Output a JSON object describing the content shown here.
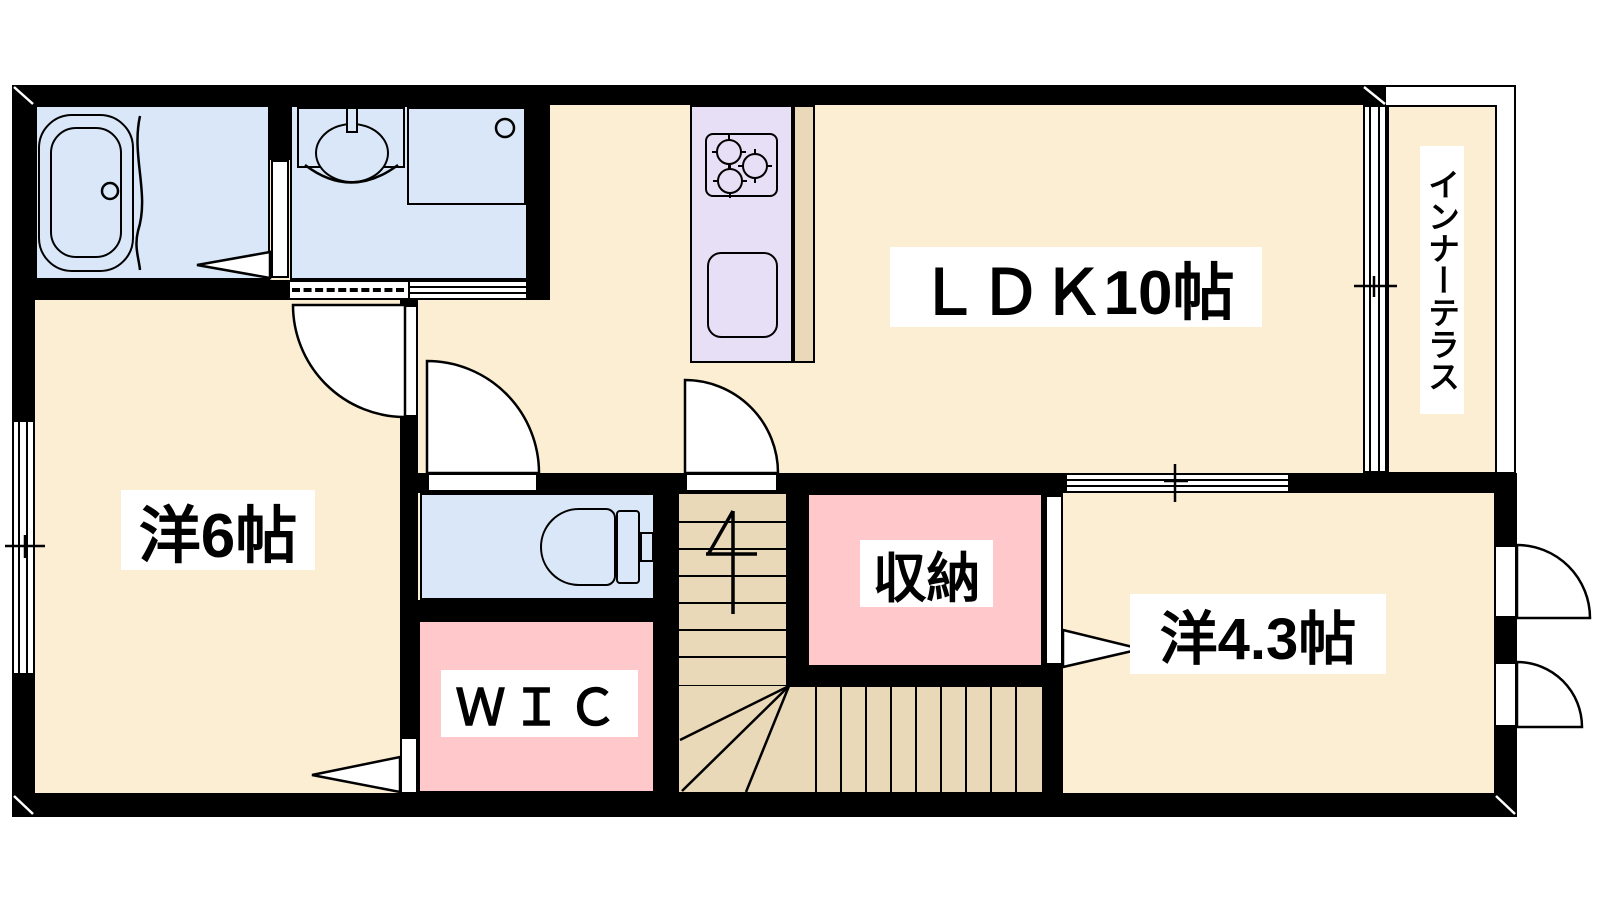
{
  "floorplan": {
    "rooms": {
      "ldk": {
        "label": "ＬＤＫ10帖"
      },
      "western6": {
        "label": "洋6帖"
      },
      "western43": {
        "label": "洋4.3帖"
      },
      "storage": {
        "label": "収納"
      },
      "wic": {
        "label": "ＷＩＣ"
      },
      "terrace": {
        "label": "インナーテラス"
      }
    },
    "colors": {
      "room_cream": "#FCEED2",
      "wet_area_blue": "#D9E7F8",
      "storage_pink": "#FFC8CB",
      "kitchen_purple": "#E7DFF5",
      "stairs_tan": "#EAD9B8",
      "wall_black": "#000000",
      "label_bg": "#FFFFFF"
    }
  }
}
